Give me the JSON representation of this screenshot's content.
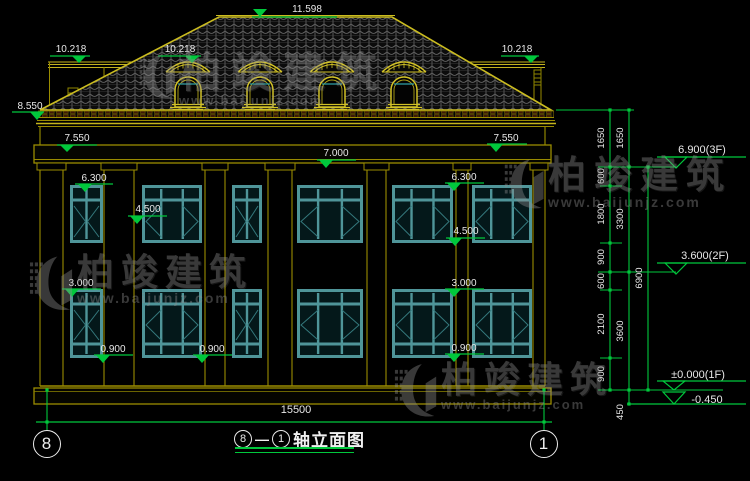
{
  "drawing_title": {
    "axis_from": "8",
    "dash": "—",
    "axis_to": "1",
    "name": "轴立面图"
  },
  "axis_bubbles": [
    {
      "label": "8",
      "cx": 47,
      "cy": 444
    },
    {
      "label": "1",
      "cx": 544,
      "cy": 444
    }
  ],
  "overall_dim": {
    "value": "15500",
    "text_x": 296,
    "text_y": 413,
    "line": [
      36,
      552,
      422
    ],
    "ext": [
      [
        47,
        390,
        431
      ],
      [
        544,
        390,
        431
      ]
    ],
    "dots": [
      [
        47,
        390
      ],
      [
        544,
        390
      ],
      [
        47,
        422
      ],
      [
        544,
        422
      ]
    ]
  },
  "spot_markers": [
    {
      "label": "11.598",
      "tx": 307,
      "ty": 8,
      "line": [
        252,
        337,
        17
      ],
      "apex": [
        260,
        17
      ],
      "above": true
    },
    {
      "label": "10.218",
      "tx": 71,
      "ty": 48,
      "line": [
        50,
        90,
        56
      ],
      "apex": [
        79,
        63
      ],
      "above": false
    },
    {
      "label": "10.218",
      "tx": 180,
      "ty": 48,
      "line": [
        158,
        201,
        56
      ],
      "apex": [
        192,
        63
      ],
      "above": false
    },
    {
      "label": "10.218",
      "tx": 517,
      "ty": 48,
      "line": [
        501,
        539,
        56
      ],
      "apex": [
        531,
        63
      ],
      "above": false
    },
    {
      "label": "8.550",
      "tx": 30,
      "ty": 105,
      "line": [
        12,
        44,
        112
      ],
      "apex": [
        37,
        120
      ],
      "above": false
    },
    {
      "label": "7.550",
      "tx": 77,
      "ty": 137,
      "line": [
        57,
        97,
        145
      ],
      "apex": [
        67,
        152
      ],
      "above": false
    },
    {
      "label": "7.550",
      "tx": 506,
      "ty": 137,
      "line": [
        487,
        527,
        144
      ],
      "apex": [
        496,
        152
      ],
      "above": false
    },
    {
      "label": "7.000",
      "tx": 336,
      "ty": 152,
      "line": [
        317,
        356,
        160
      ],
      "apex": [
        326,
        168
      ],
      "above": false
    },
    {
      "label": "6.300",
      "tx": 94,
      "ty": 177,
      "line": [
        75,
        113,
        184
      ],
      "apex": [
        85,
        192
      ],
      "above": false
    },
    {
      "label": "6.300",
      "tx": 464,
      "ty": 176,
      "line": [
        445,
        484,
        183
      ],
      "apex": [
        454,
        191
      ],
      "above": false
    },
    {
      "label": "4.500",
      "tx": 148,
      "ty": 208,
      "line": [
        128,
        167,
        216
      ],
      "apex": [
        137,
        224
      ],
      "above": false
    },
    {
      "label": "4.500",
      "tx": 466,
      "ty": 230,
      "line": [
        446,
        485,
        238
      ],
      "apex": [
        455,
        246
      ],
      "above": false
    },
    {
      "label": "3.000",
      "tx": 81,
      "ty": 282,
      "line": [
        62,
        101,
        289
      ],
      "apex": [
        72,
        297
      ],
      "above": false
    },
    {
      "label": "3.000",
      "tx": 464,
      "ty": 282,
      "line": [
        445,
        484,
        289
      ],
      "apex": [
        454,
        297
      ],
      "above": false
    },
    {
      "label": "0.900",
      "tx": 113,
      "ty": 348,
      "line": [
        94,
        133,
        355
      ],
      "apex": [
        103,
        363
      ],
      "above": false
    },
    {
      "label": "0.900",
      "tx": 212,
      "ty": 348,
      "line": [
        193,
        232,
        355
      ],
      "apex": [
        202,
        363
      ],
      "above": false
    },
    {
      "label": "0.900",
      "tx": 464,
      "ty": 347,
      "line": [
        445,
        484,
        354
      ],
      "apex": [
        454,
        362
      ],
      "above": false
    }
  ],
  "floor_markers": [
    {
      "label": "6.900(3F)",
      "tx": 702,
      "ty": 149,
      "line": [
        657,
        746,
        157
      ],
      "tri": [
        665,
        687,
        157,
        168
      ],
      "ext": [
        598,
        676,
        167
      ]
    },
    {
      "label": "3.600(2F)",
      "tx": 705,
      "ty": 255,
      "line": [
        657,
        746,
        263
      ],
      "tri": [
        665,
        687,
        263,
        274
      ],
      "ext": [
        598,
        676,
        272
      ]
    },
    {
      "label": "±0.000(1F)",
      "tx": 698,
      "ty": 374,
      "line": [
        657,
        746,
        381
      ],
      "tri": [
        663,
        685,
        381,
        390
      ],
      "ext": [
        598,
        723,
        390
      ]
    },
    {
      "label": "-0.450",
      "tx": 707,
      "ty": 399,
      "line": [
        627,
        746,
        404
      ],
      "tri": [
        663,
        685,
        392,
        404
      ],
      "ext": null
    }
  ],
  "chains": [
    {
      "x": 610,
      "y1": 110,
      "y2": 390,
      "dots": [
        110,
        167,
        186,
        243,
        272,
        290,
        358,
        390
      ],
      "labels": [
        {
          "v": "1650",
          "y": 138
        },
        {
          "v": "600",
          "y": 176
        },
        {
          "v": "1800",
          "y": 214
        },
        {
          "v": "900",
          "y": 257
        },
        {
          "v": "600",
          "y": 281
        },
        {
          "v": "2100",
          "y": 324
        },
        {
          "v": "900",
          "y": 374
        }
      ]
    },
    {
      "x": 629,
      "y1": 110,
      "y2": 404,
      "dots": [
        110,
        167,
        272,
        390,
        404
      ],
      "labels": [
        {
          "v": "1650",
          "y": 138
        },
        {
          "v": "3300",
          "y": 219
        },
        {
          "v": "3600",
          "y": 331
        },
        {
          "v": "450",
          "y": 412
        }
      ]
    },
    {
      "x": 648,
      "y1": 167,
      "y2": 390,
      "dots": [
        167,
        390
      ],
      "labels": [
        {
          "v": "6900",
          "y": 278
        }
      ]
    }
  ],
  "chain_ticks": [
    [
      556,
      634,
      110
    ],
    [
      600,
      622,
      186
    ],
    [
      600,
      622,
      243
    ],
    [
      600,
      622,
      290
    ],
    [
      600,
      622,
      358
    ]
  ],
  "watermark": {
    "brand": "柏竣建筑",
    "url": "www.baijunjz.com",
    "instances": [
      {
        "x": 138,
        "y": 52,
        "logo_h": 50,
        "brand_size": 42,
        "brand_ls": 10,
        "url_size": 13
      },
      {
        "x": 503,
        "y": 157,
        "logo_h": 55,
        "brand_size": 38,
        "brand_ls": 8,
        "url_size": 14
      },
      {
        "x": 28,
        "y": 254,
        "logo_h": 60,
        "brand_size": 37,
        "brand_ls": 7,
        "url_size": 14
      },
      {
        "x": 393,
        "y": 362,
        "logo_h": 58,
        "brand_size": 36,
        "brand_ls": 7,
        "url_size": 13
      }
    ]
  },
  "building": {
    "roof": {
      "eave": [
        40,
        551,
        110
      ],
      "ridge": [
        219,
        392,
        17
      ]
    },
    "dormer_cx": [
      188,
      260,
      332,
      404
    ],
    "pilasters": [
      [
        40,
        63
      ],
      [
        104,
        134
      ],
      [
        205,
        225
      ],
      [
        268,
        292
      ],
      [
        367,
        386
      ],
      [
        456,
        468
      ],
      [
        533,
        545
      ]
    ],
    "windows_2f": {
      "y": 185,
      "h": 58,
      "rail": 200,
      "items": [
        {
          "x": 70,
          "w": 33,
          "cols": 2
        },
        {
          "x": 142,
          "w": 60,
          "cols": 3
        },
        {
          "x": 232,
          "w": 30,
          "cols": 2
        },
        {
          "x": 297,
          "w": 66,
          "cols": 3
        },
        {
          "x": 392,
          "w": 61,
          "cols": 3
        },
        {
          "x": 472,
          "w": 60,
          "cols": 3
        }
      ]
    },
    "windows_1f": {
      "y": 289,
      "h": 69,
      "rail": 304,
      "rail2": 344,
      "items": [
        {
          "x": 70,
          "w": 33,
          "cols": 2
        },
        {
          "x": 142,
          "w": 60,
          "cols": 3
        },
        {
          "x": 232,
          "w": 30,
          "cols": 2
        },
        {
          "x": 297,
          "w": 66,
          "cols": 3
        },
        {
          "x": 392,
          "w": 61,
          "cols": 3
        },
        {
          "x": 472,
          "w": 60,
          "cols": 3
        }
      ]
    }
  },
  "colors": {
    "green": "#00c83c",
    "yellow": "#d2c226",
    "olive": "#9a8c00",
    "teal": "#4f9599",
    "teal_dark": "#34787c",
    "white": "#e8e8e8",
    "maroon": "#3d1708",
    "tile": "#6e6e6e"
  }
}
